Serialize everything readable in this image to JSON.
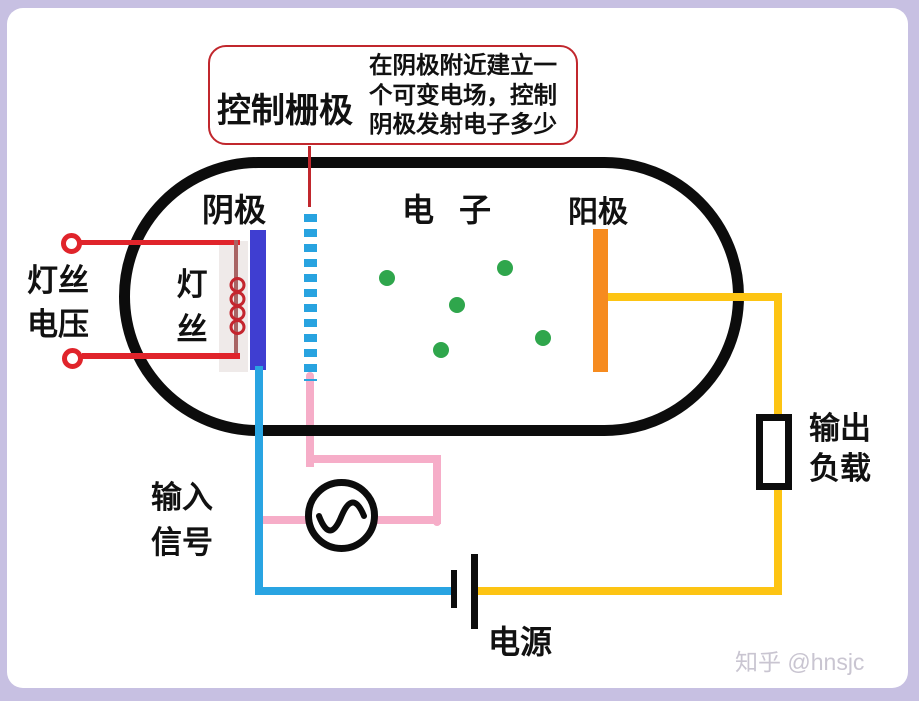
{
  "palette": {
    "background": "#c7c0e2",
    "surface": "#ffffff",
    "tube_outline": "#0c0c0c",
    "cathode_blue": "#3f3ed1",
    "grid_cyan": "#28a3e0",
    "anode_orange": "#f68b1f",
    "wire_cyan": "#29a4e2",
    "wire_pink": "#f6adc8",
    "wire_yellow": "#fdc413",
    "wire_red": "#e0242b",
    "callout_red": "#c1272d",
    "electron_green": "#2fa64c",
    "watermark_gray": "#c9c5d1"
  },
  "annotation": {
    "title": "控制栅极",
    "line1": "在阴极附近建立一",
    "line2": "个可变电场，控制",
    "line3": "阴极发射电子多少"
  },
  "tube": {
    "cathode_label": "阴极",
    "electrons_label": "电子",
    "anode_label": "阳极",
    "filament_line1": "灯",
    "filament_line2": "丝"
  },
  "external": {
    "filament_voltage_line1": "灯丝",
    "filament_voltage_line2": "电压",
    "input_signal_line1": "输入",
    "input_signal_line2": "信号",
    "output_load_line1": "输出",
    "output_load_line2": "负载",
    "power_label": "电源"
  },
  "electrons": [
    {
      "x": 387,
      "y": 278
    },
    {
      "x": 505,
      "y": 268
    },
    {
      "x": 457,
      "y": 305
    },
    {
      "x": 543,
      "y": 338
    },
    {
      "x": 441,
      "y": 350
    }
  ],
  "watermark": "知乎 @hnsjc"
}
